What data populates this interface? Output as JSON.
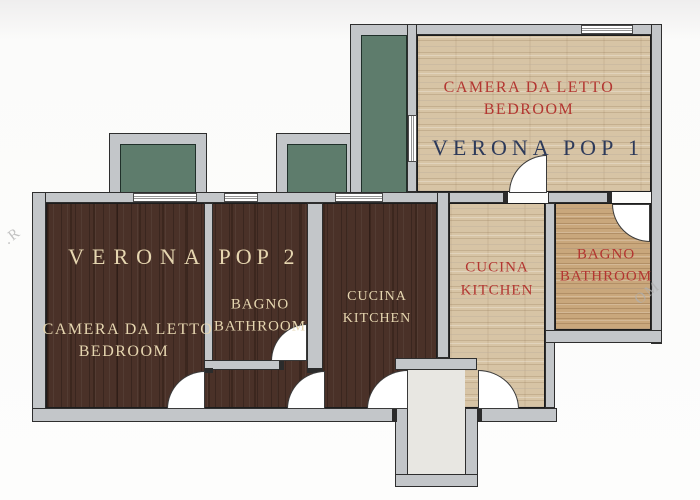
{
  "apartments": {
    "pop1": {
      "name": "VERONA POP 1",
      "bedroom": {
        "it": "CAMERA DA LETTO",
        "en": "BEDROOM"
      },
      "kitchen": {
        "it": "CUCINA",
        "en": "KITCHEN"
      },
      "bathroom": {
        "it": "BAGNO",
        "en": "BATHROOM"
      }
    },
    "pop2": {
      "name_part1": "VERONA",
      "name_part2": "POP 2",
      "bedroom": {
        "it": "CAMERA DA LETTO",
        "en": "BEDROOM"
      },
      "bathroom": {
        "it": "BAGNO",
        "en": "BATHROOM"
      },
      "kitchen": {
        "it": "CUCINA",
        "en": "KITCHEN"
      }
    }
  },
  "watermark": {
    "left": ".R",
    "right": "OM"
  },
  "colors": {
    "dark_wood": "#4a3128",
    "light_wood": "#d7c4a5",
    "tan_wood": "#c9a77c",
    "balcony_green": "#5e7c6c",
    "wall_gray": "#c3c6c9",
    "hallway_beige": "#e8e7e2",
    "label_cream": "#e6d6b0",
    "label_red": "#b33631",
    "label_navy": "#2d3a5a"
  }
}
